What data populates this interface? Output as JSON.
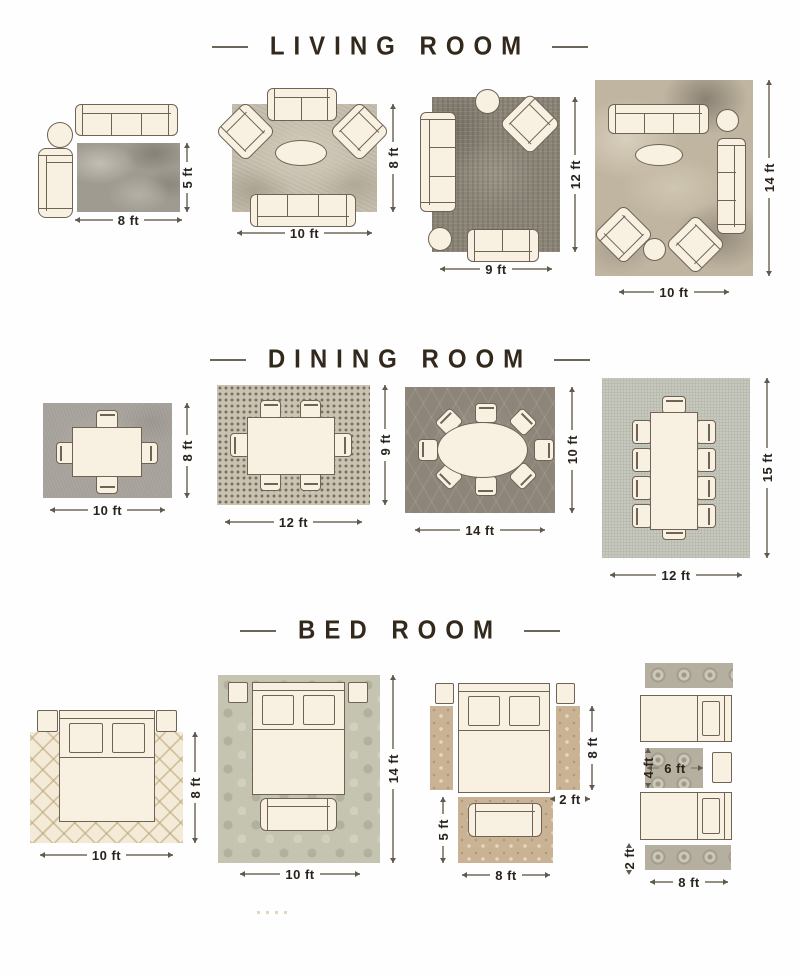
{
  "colors": {
    "title_text": "#33281c",
    "dimension_text": "#29231c",
    "furniture_fill": "#f8f1e1",
    "furniture_line": "#6e6355"
  },
  "sections": {
    "living": {
      "title": "LIVING ROOM",
      "layouts": {
        "l1": {
          "width": "8 ft",
          "height": "5 ft"
        },
        "l2": {
          "width": "10 ft",
          "height": "8 ft"
        },
        "l3": {
          "width": "9 ft",
          "height": "12 ft"
        },
        "l4": {
          "width": "10 ft",
          "height": "14 ft"
        }
      }
    },
    "dining": {
      "title": "DINING ROOM",
      "layouts": {
        "d1": {
          "width": "10 ft",
          "height": "8 ft"
        },
        "d2": {
          "width": "12 ft",
          "height": "9 ft"
        },
        "d3": {
          "width": "14 ft",
          "height": "10 ft"
        },
        "d4": {
          "width": "12 ft",
          "height": "15 ft"
        }
      }
    },
    "bed": {
      "title": "BED ROOM",
      "layouts": {
        "b1": {
          "width": "10 ft",
          "height": "8 ft"
        },
        "b2": {
          "width": "10 ft",
          "height": "14 ft"
        },
        "b3": {
          "runner_height": "8 ft",
          "runner_width": "2 ft",
          "rug_height": "5 ft",
          "rug_width": "8 ft"
        },
        "b4": {
          "mid_height": "4 ft",
          "mid_width": "6 ft",
          "runner_height": "2 ft",
          "runner_width": "8 ft"
        }
      }
    }
  }
}
